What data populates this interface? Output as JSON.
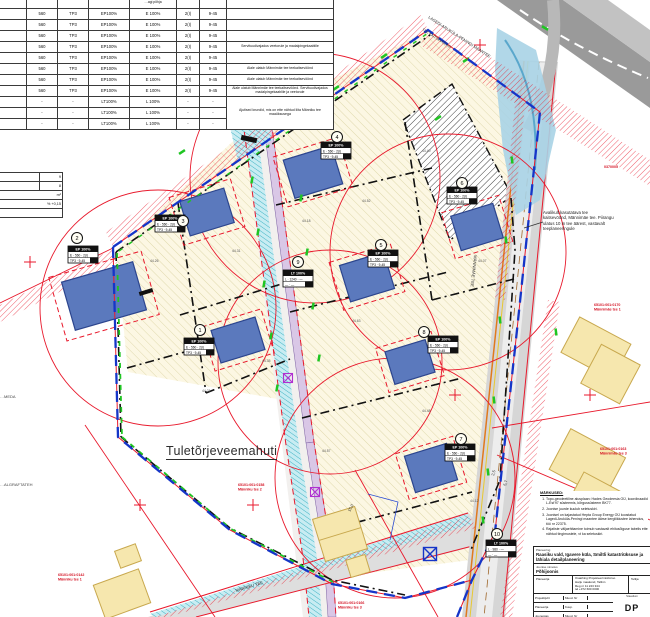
{
  "colors": {
    "boundary_blue": "#1535c8",
    "line_red": "#e8192c",
    "building_blue": "#5b79bd",
    "plot_cream": "#fcf7e3",
    "ditch_teal": "#3fb3c4",
    "road_lavender": "#d9c7e6",
    "road_grey": "#c9c9c9",
    "green_mark": "#1fc522",
    "existing_yellow": "#f6e7ae"
  },
  "table": {
    "header_note": "…agi põhja",
    "rows": [
      {
        "c": [
          "560",
          "TP3",
          "EP100%",
          "E 100%",
          "2(I)",
          "9-45"
        ],
        "r": ""
      },
      {
        "c": [
          "560",
          "TP3",
          "EP100%",
          "E 100%",
          "2(I)",
          "9-45"
        ],
        "r": ""
      },
      {
        "c": [
          "560",
          "TP3",
          "EP100%",
          "E 100%",
          "2(I)",
          "9-45"
        ],
        "r": ""
      },
      {
        "c": [
          "560",
          "TP3",
          "EP100%",
          "E 100%",
          "2(I)",
          "9-45"
        ],
        "r": "Servituudivajadus veetorule ja madalpingekaablile"
      },
      {
        "c": [
          "560",
          "TP3",
          "EP100%",
          "E 100%",
          "2(I)",
          "9-45"
        ],
        "r": ""
      },
      {
        "c": [
          "560",
          "TP3",
          "EP100%",
          "E 100%",
          "2(I)",
          "9-45"
        ],
        "r": "Alale ulatub Männimäe tee teekaitsevöönd"
      },
      {
        "c": [
          "560",
          "TP3",
          "EP100%",
          "E 100%",
          "2(I)",
          "9-45"
        ],
        "r": "Alale ulatub Männimäe tee teekaitsevöönd"
      },
      {
        "c": [
          "560",
          "TP3",
          "EP100%",
          "E 100%",
          "2(I)",
          "9-45"
        ],
        "r": "Alale ulatub Männimäe tee teekaitsevöönd. Servituudivajadus madalpingekaablile ja veetorule"
      },
      {
        "c": [
          "-",
          "-",
          "LT100%",
          "L 100%",
          "-",
          "-"
        ],
        "r": "Ajutised krundid, mis on ette nähtud liita Männiku tee maaüksusega"
      },
      {
        "c": [
          "-",
          "-",
          "LT100%",
          "L 100%",
          "-",
          "-"
        ],
        "r": ""
      },
      {
        "c": [
          "-",
          "-",
          "LT100%",
          "L 100%",
          "-",
          "-"
        ],
        "r": ""
      }
    ]
  },
  "fragment_table": {
    "rows": [
      "9",
      "8",
      "m²",
      "% +0,15",
      ""
    ]
  },
  "annotation": {
    "lines": [
      "Avalikult kasutatava tee",
      "kaitsevöönd, Männimäe tee. Piirangu",
      "ulatus 10 m tee äärest, vastavalt",
      "teeplaneeringule"
    ]
  },
  "map": {
    "labels": {
      "fire_tank": "Tuletõrjeveemahuti",
      "road_main": "LAGEDI-ARUKÜLA-PENINGI MAANTEE",
      "road_main2": "TEE KAITSEVÖÖND",
      "road_right": "MÄNNIMÄE TEE",
      "road_bottom": "MÄNNIKU TEE",
      "frag1": "…MEDA",
      "frag2": "…ALGRAFTATEH",
      "dim1": "15,0",
      "dim2": "2,5",
      "dim3": "5,7",
      "code": "0370005"
    },
    "plots": [
      {
        "num": "1",
        "box": {
          "h": "EP 100%",
          "a": "E · 560 · 2(I)",
          "b": "TP3 · 9-45"
        }
      },
      {
        "num": "2",
        "box": {
          "h": "EP 100%",
          "a": "E · 560 · 2(I)",
          "b": "TP3 · 9-45"
        }
      },
      {
        "num": "3",
        "box": {
          "h": "EP 100%",
          "a": "E · 560 · 2(I)",
          "b": "TP3 · 9-45"
        }
      },
      {
        "num": "4",
        "box": {
          "h": "EP 100%",
          "a": "E · 560 · 2(I)",
          "b": "TP3 · 9-45"
        }
      },
      {
        "num": "5",
        "box": {
          "h": "EP 100%",
          "a": "E · 560 · 2(I)",
          "b": "TP3 · 9-45"
        }
      },
      {
        "num": "6",
        "box": {
          "h": "EP 100%",
          "a": "E · 560 · 2(I)",
          "b": "TP3 · 9-45"
        }
      },
      {
        "num": "7",
        "box": {
          "h": "EP 100%",
          "a": "E · 560 · 2(I)",
          "b": "TP3 · 9-45"
        }
      },
      {
        "num": "8",
        "box": {
          "h": "EP 100%",
          "a": "E · 560 · 2(I)",
          "b": "TP3 · 9-45"
        }
      },
      {
        "num": "9",
        "box": {
          "h": "LT 100%",
          "a": "L · 1240 · —",
          "b": "— · —"
        }
      },
      {
        "num": "10",
        "box": {
          "h": "LT 100%",
          "a": "L · 980 · —",
          "b": "— · —"
        }
      }
    ],
    "elevations": [
      "44.26",
      "44.31",
      "44.18",
      "44.52",
      "44.40",
      "44.07",
      "44.63",
      "44.35",
      "44.21",
      "44.48",
      "44.12",
      "44.57"
    ],
    "red_labels": [
      {
        "l1": "65101:001:0158",
        "l2": "Männiku tee 2"
      },
      {
        "l1": "65101:001:0142",
        "l2": "Männiku tee 1"
      },
      {
        "l1": "65101:001:0166",
        "l2": "Männiku tee 3"
      },
      {
        "l1": "65101:001:0170",
        "l2": "Männimäe tee 1"
      },
      {
        "l1": "65101:001:0163",
        "l2": "Männimäe tee 3"
      }
    ]
  },
  "notes": {
    "title": "MÄRKUSED:",
    "items": [
      "Topo-geodeetiline alusplaan: Hades Geodeesia OÜ, koordinaadid L-Est'97 süsteemis, kõrgussüsteem BK77.",
      "Joonise juurde kuulub seletuskiri.",
      "Joonisel on kajastatud Hepta Group Energy OÜ koostatud Lagedi-Aruküla-Peningi maantee äärse kergliiklustee lahendus, töö nr 22375.",
      "Rajatiste väljaehitamine toimub vastavalt ehitusõiguse tabelis ette nähtud tingimustele, vt ka seletuskiri."
    ]
  },
  "titleblock": {
    "project_label": "Planeering",
    "project": "Raasiku vald, Igavere küla, Smiltli katastriüksuse ja lähiala detailplaneering",
    "sheet_label": "Joonise nimetus",
    "sheet": "Põhijoonis",
    "firm_label": "Planeerija",
    "firm_lines": [
      "Osaühing Projekteerimisbüroo",
      "Harju maakond, Tallinn",
      "Reg nr 11 223 344",
      "tel +372 600 0000"
    ],
    "client_label": "Tellija",
    "rows": [
      {
        "a": "Projektijuht",
        "b": "Muud. Nr"
      },
      {
        "a": "Planeerija",
        "b": "Kuup."
      },
      {
        "a": "Joonestas",
        "b": "Muud. Nr"
      },
      {
        "a": "Kontrollis",
        "b": "Kuup."
      }
    ],
    "stage_label": "Staadium",
    "stage": "DP",
    "date_label": "Kuupäev",
    "date": "10.10.2013"
  }
}
